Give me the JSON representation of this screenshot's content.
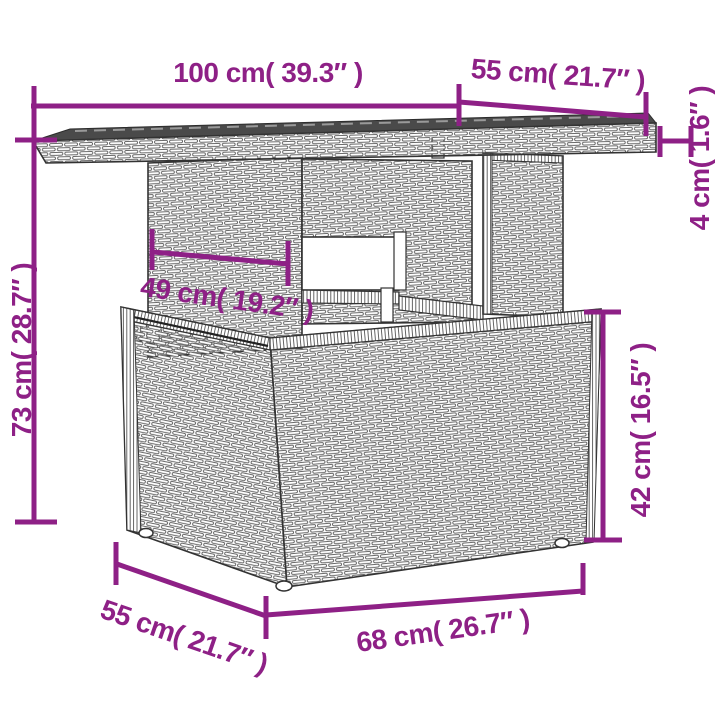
{
  "diagram": {
    "subject": "rattan garden table with storage base — dimension diagram",
    "accent_color": "#8E2086",
    "outline_color": "#333333"
  },
  "measurements": [
    {
      "id": "table-width",
      "cm": 100,
      "inch": 39.3,
      "label": "100 cm( 39.3″ )"
    },
    {
      "id": "table-depth",
      "cm": 55,
      "inch": 21.7,
      "label": "55 cm( 21.7″ )"
    },
    {
      "id": "tabletop-thickness",
      "cm": 4,
      "inch": 1.6,
      "label": "4 cm( 1.6″ )"
    },
    {
      "id": "table-height",
      "cm": 73,
      "inch": 28.7,
      "label": "73 cm( 28.7″ )"
    },
    {
      "id": "base-width",
      "cm": 49,
      "inch": 19.2,
      "label": "49 cm( 19.2″ )"
    },
    {
      "id": "box-height",
      "cm": 42,
      "inch": 16.5,
      "label": "42 cm( 16.5″ )"
    },
    {
      "id": "box-depth",
      "cm": 55,
      "inch": 21.7,
      "label": "55 cm( 21.7″ )"
    },
    {
      "id": "box-width",
      "cm": 68,
      "inch": 26.7,
      "label": "68 cm( 26.7″ )"
    }
  ]
}
